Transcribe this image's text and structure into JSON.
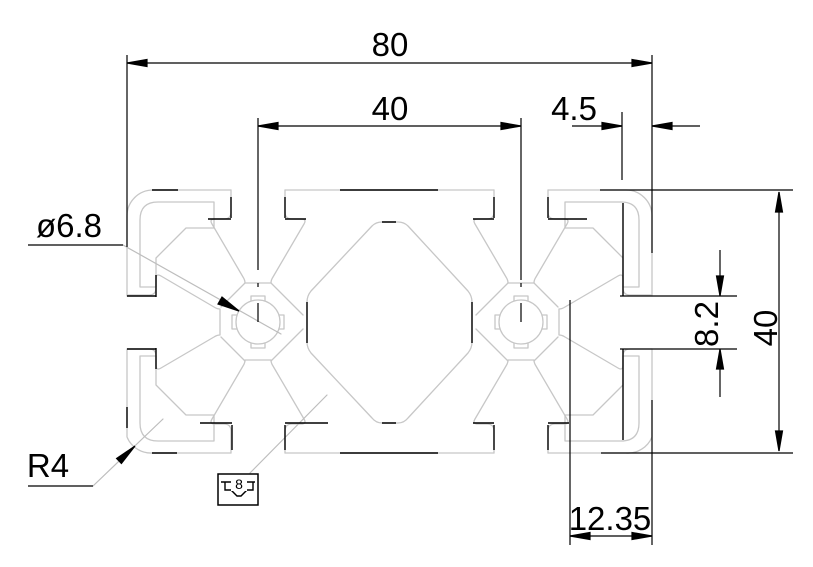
{
  "drawing": {
    "title": "aluminium-extrusion-profile-80x40-cross-section",
    "units": "mm",
    "colors": {
      "dimension_lines": "#000000",
      "profile_outline": "#c7c7c7",
      "leader_lines": "#bdbdbd",
      "background": "#ffffff"
    },
    "labels": {
      "overall_width": "80",
      "slot_pitch": "40",
      "slot_mouth_depth": "4.5",
      "core_hole_diameter": "ø6.8",
      "slot_opening_width": "8.2",
      "overall_height": "40",
      "corner_radius": "R4",
      "bottom_edge_offset": "12.35",
      "slot_nominal_size": "8"
    }
  }
}
